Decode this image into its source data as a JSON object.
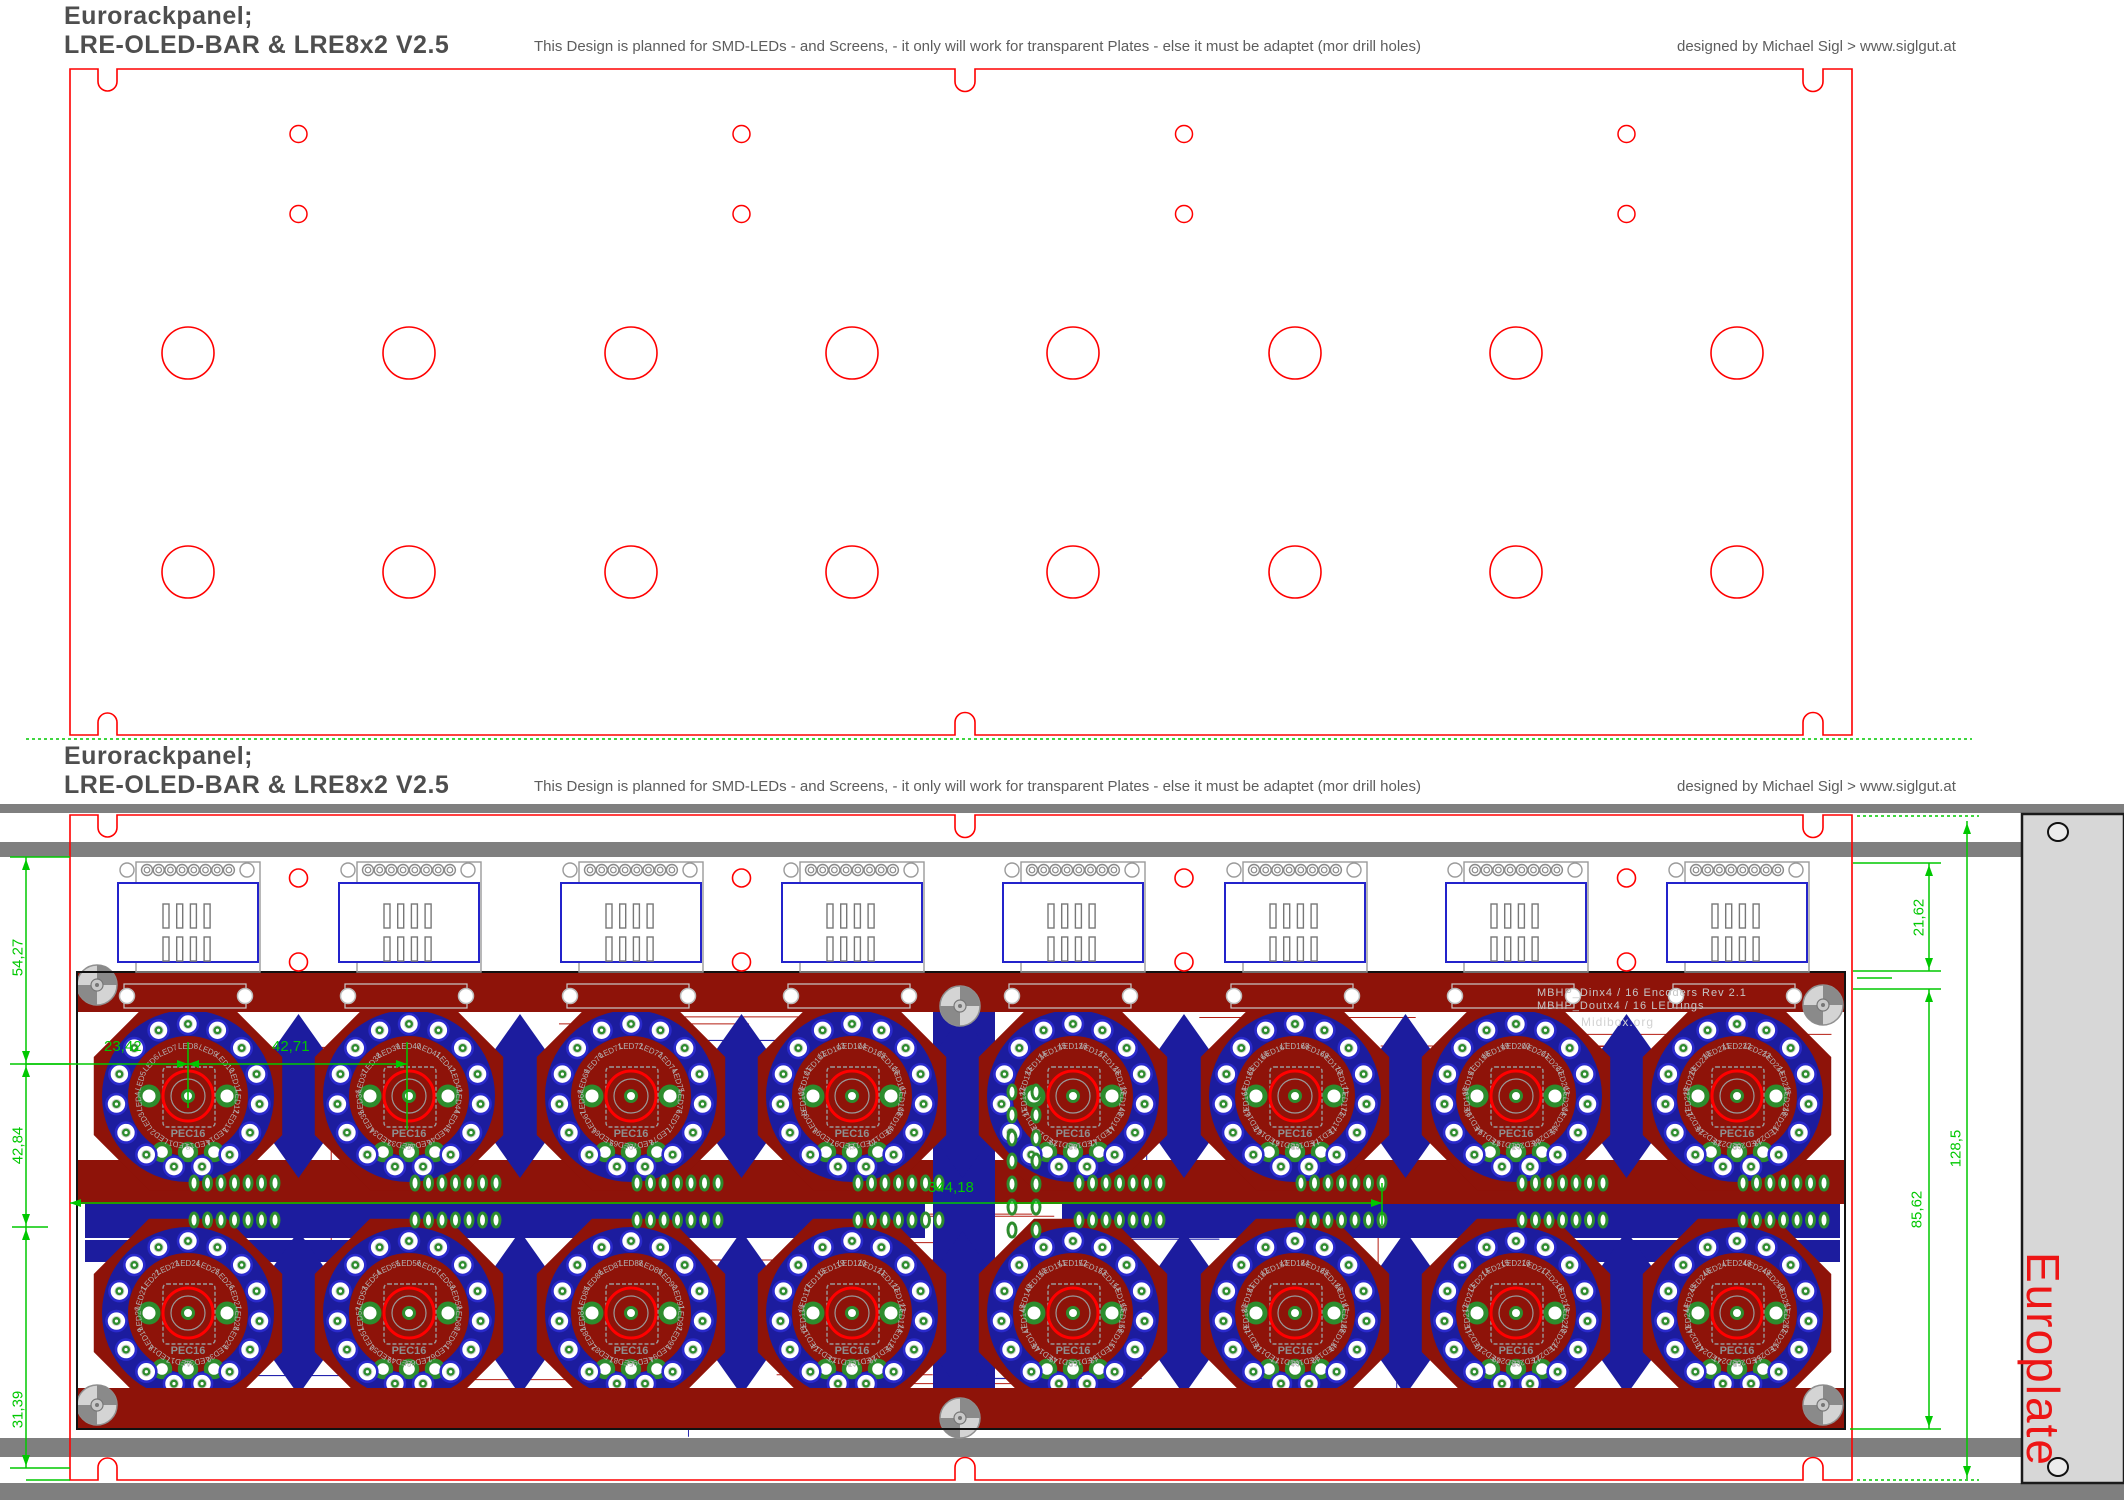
{
  "window": {
    "title_line1": "Eurorackpanel;",
    "title_line2": "LRE-OLED-BAR  &  LRE8x2 V2.5",
    "note": "This Design is planned for SMD-LEDs - and Screens, -  it only will work for transparent Plates   -  else it must be adaptet (mor drill holes)",
    "credit": "designed by Michael Sigl  >  www.siglgut.at"
  },
  "pcb_silkscreen": {
    "line1": "MBHP_Dinx4 / 16 Encoders  Rev 2.1",
    "line2": "MBHP_Doutx4 / 16 LEDrings",
    "line3": "Midibox.org",
    "encoder_label": "PEC16",
    "led_prefix": "LED"
  },
  "europlate": {
    "label": "Europlate"
  },
  "dimensions": {
    "left": [
      "54,27",
      "42,84",
      "31,39"
    ],
    "encoder_pitch": [
      "23,42",
      "42,71"
    ],
    "board_width": "344,18",
    "right": [
      "21,62",
      "85,62",
      "128,5"
    ]
  },
  "led_numbering": {
    "row1_starts": [
      1,
      33,
      65,
      97,
      129,
      161,
      193,
      225
    ],
    "row2_starts": [
      17,
      49,
      81,
      113,
      145,
      177,
      209,
      241
    ]
  },
  "colors": {
    "outline_red": "#ff0000",
    "dimension_green": "#00c800",
    "pcb_copper_red": "#8e1309",
    "pcb_copper_blue": "#1c1c9e",
    "trace_red": "#b51d12",
    "trace_blue": "#2424ae",
    "pad_green": "#2d8c2d",
    "rail_gray": "#7f7f7f",
    "silk_gray": "#9a9a9a",
    "europlate_bg": "#d7d7d7",
    "europlate_text": "#ed1515"
  }
}
